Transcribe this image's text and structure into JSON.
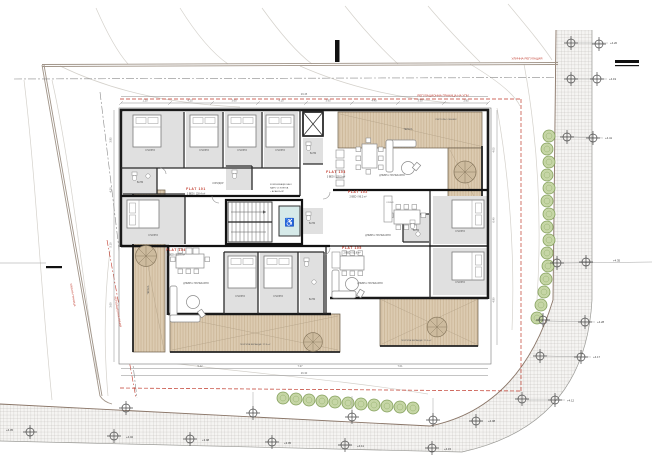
{
  "plan": {
    "flats": [
      {
        "name": "FLAT 101",
        "info": "3 BED / 128.4 m²"
      },
      {
        "name": "FLAT 102",
        "info": "2 BED / 96.2 m²"
      },
      {
        "name": "FLAT 103",
        "info": "3 BED / 135.5 m²"
      },
      {
        "name": "FLAT 104",
        "info": "3 BED / 118.6 m²"
      },
      {
        "name": "FLAT 105",
        "info": "2 BED / 92.8 m²"
      }
    ],
    "core_label": {
      "l1": "КОМУНИКАЦИОННО",
      "l2": "ЯДРО СТ.КЛЕТКА",
      "l3": "+ АСАНСЬОР"
    },
    "rooms": {
      "bedroom": "СПАЛНЯ",
      "bath": "БАНЯ",
      "living": "ДНЕВНА-ТРАПЕЗАРИЯ",
      "kitchen": "КУХНЯ",
      "corridor": "КОРИДОР",
      "terrace": "ТЕРАСА",
      "veranda1": "ПОКРИТА ВЕРАНДА / 27.8 m²",
      "veranda2": "ПОКРИТА ВЕРАНДА / 21.4 m²",
      "pergola": "ПЕРГОЛА / СЕННИК"
    },
    "boundaries": {
      "street_reg": "УЛИЧНА РЕГУЛАЦИЯ",
      "plot_reg": "РЕГУЛАЦИОННА ГРАНИЦА НА УПИ",
      "street_line": "УЛИЧНА ГРАНИЦА",
      "reg_line": "РЕГУЛАЦИОННА ЛИНИЯ"
    },
    "levels": [
      "+4.20",
      "+4.19",
      "+4.41",
      "+4.35",
      "+4.28",
      "+4.17",
      "+4.12",
      "+4.08",
      "+4.05",
      "+4.02",
      "+3.98",
      "+3.95",
      "+4.11",
      "+4.15"
    ],
    "dims": {
      "top": [
        "1.20",
        "4.25",
        "3.60",
        "4.10",
        "3.95",
        "4.40",
        "3.30",
        "2.85"
      ],
      "top_total": "29.45",
      "left": [
        "3.85",
        "4.20",
        "5.10",
        "3.60"
      ],
      "right": [
        "4.05",
        "6.40",
        "4.80"
      ],
      "bottom": [
        "5.42",
        "7.37",
        "7.01"
      ],
      "bottom_total": "26.30"
    },
    "colors": {
      "wall": "#1a1a1a",
      "deck": "#dccbb1",
      "room_gray": "#e0e0e0",
      "accent_red": "#c0392b",
      "hedge_green": "#c6d6a6"
    }
  }
}
